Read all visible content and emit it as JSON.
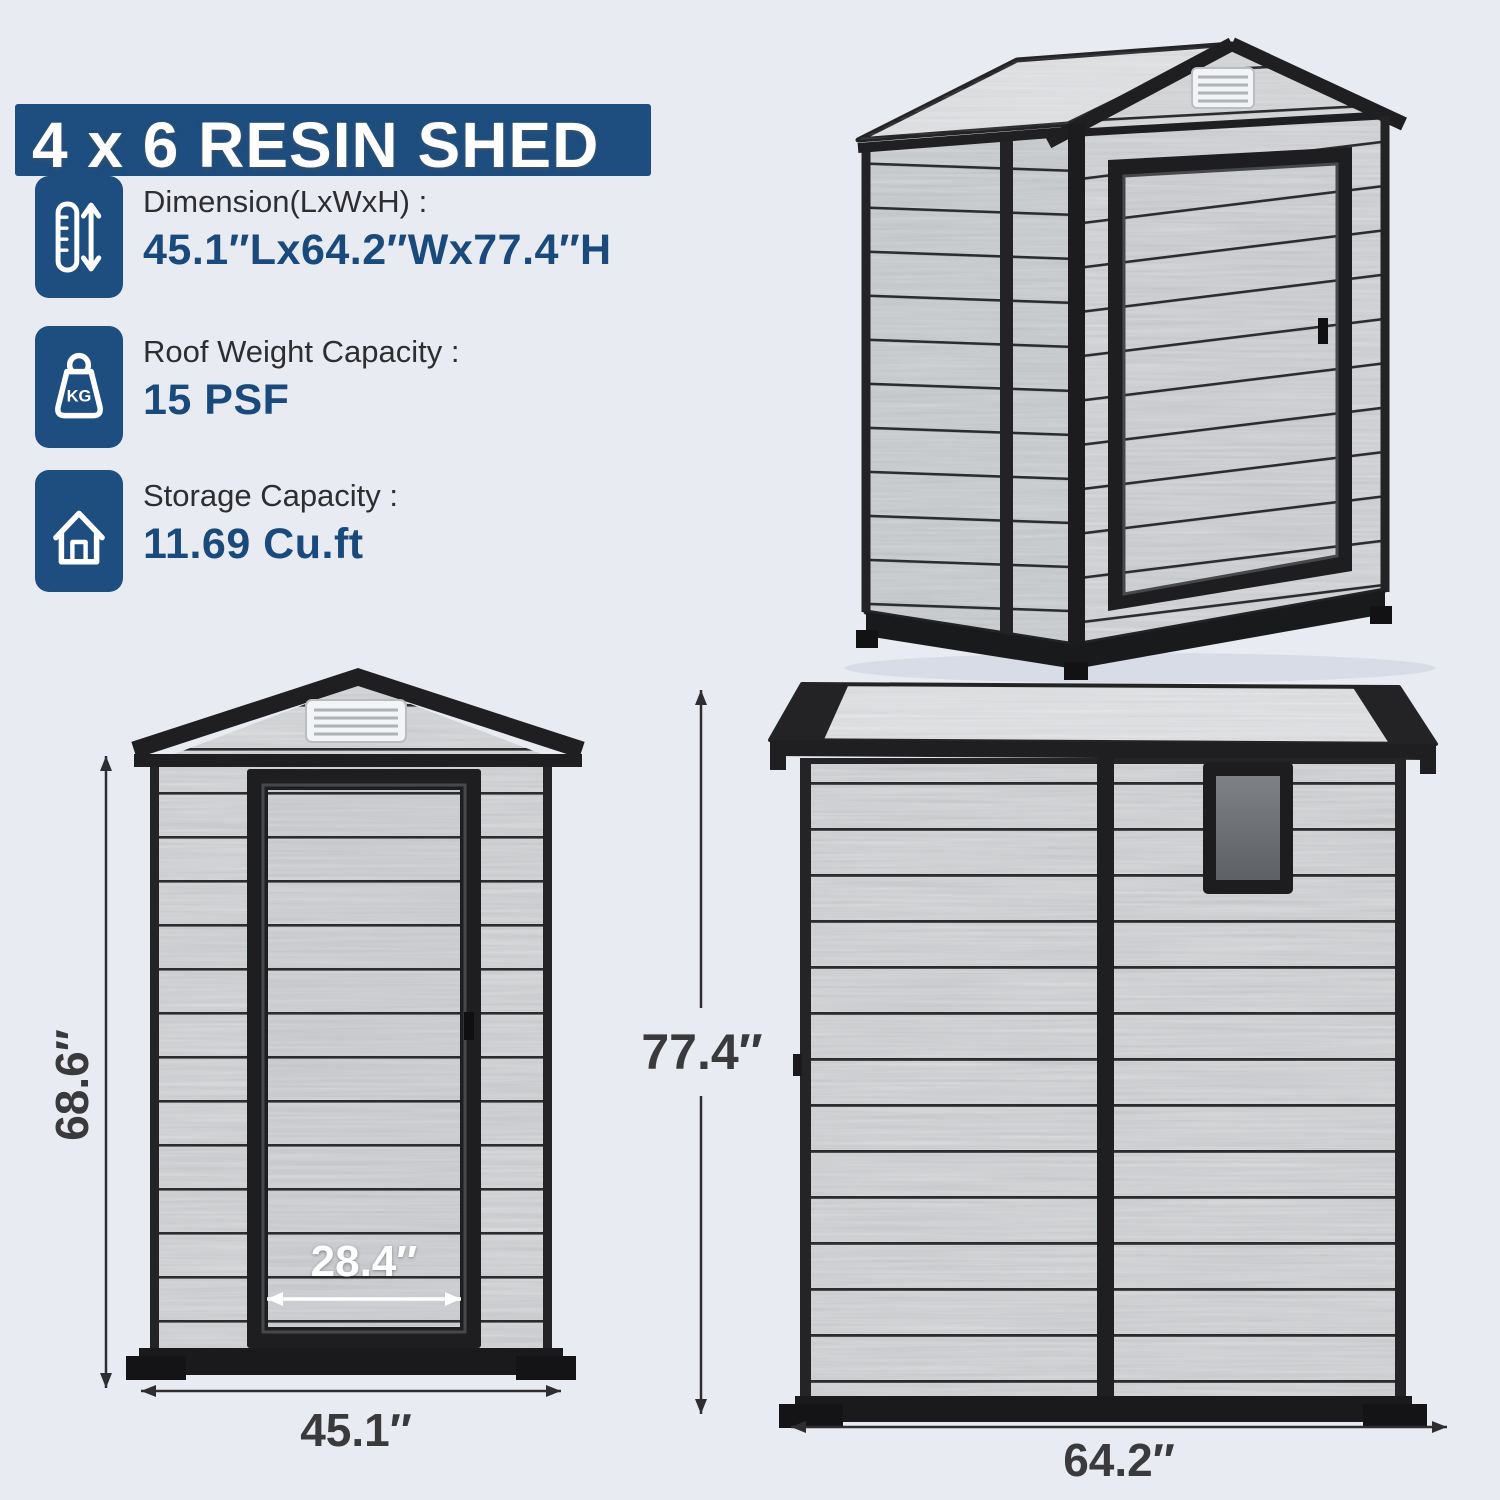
{
  "title": "4 x 6 RESIN SHED",
  "specs": [
    {
      "label": "Dimension(LxWxH) :",
      "value": "45.1″Lx64.2″Wx77.4″H"
    },
    {
      "label": "Roof Weight Capacity :",
      "value": "15 PSF"
    },
    {
      "label": "Storage Capacity :",
      "value": "11.69 Cu.ft"
    }
  ],
  "icons": {
    "kg_label": "KG"
  },
  "dimensions": {
    "front_height": "68.6″",
    "overall_height": "77.4″",
    "door_width": "28.4″",
    "front_width": "45.1″",
    "side_width": "64.2″"
  },
  "colors": {
    "accent_navy": "#1d4e7f",
    "background": "#e8ebf2",
    "dimension_text": "#3a3a3c",
    "trim_black": "#1f1f21",
    "plank_gray": "#d6d8da"
  }
}
